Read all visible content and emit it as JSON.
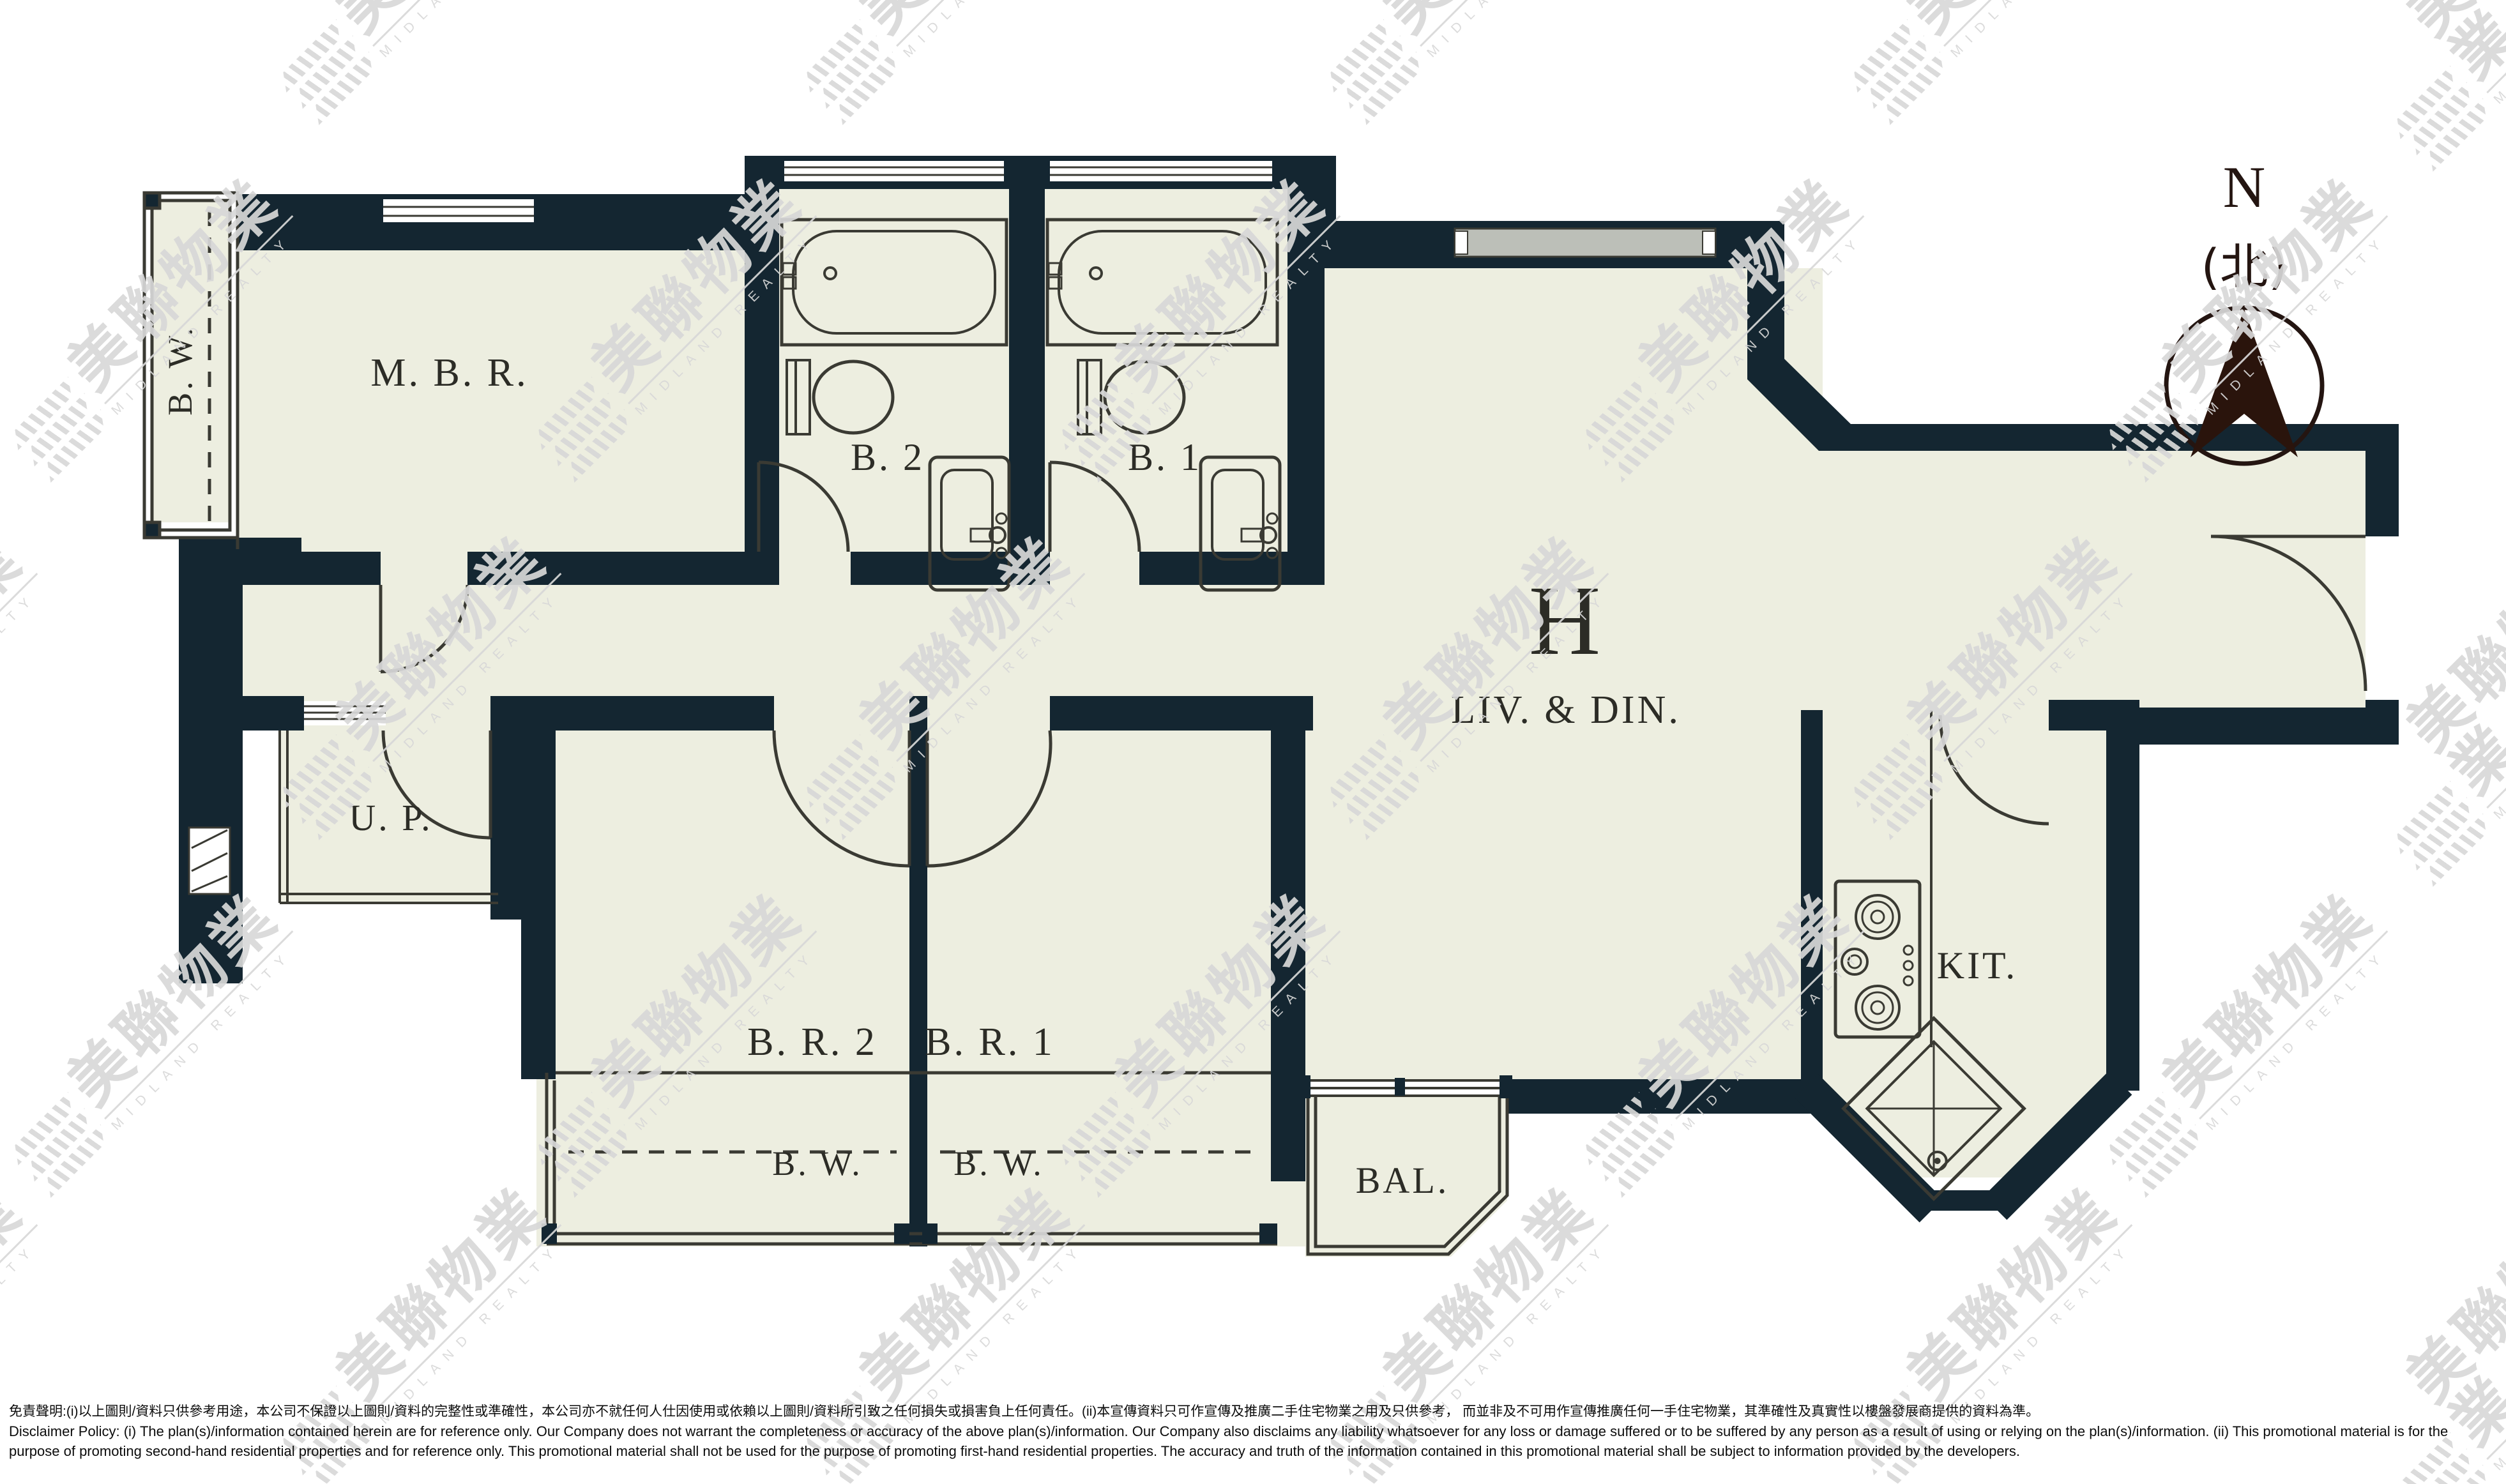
{
  "plan": {
    "unit_label": "H",
    "rooms": {
      "mbr": "M. B. R.",
      "b2": "B. 2",
      "b1": "B. 1",
      "bw_left": "B. W.",
      "up": "U. P.",
      "br2": "B. R. 2",
      "br1": "B. R. 1",
      "bw_br2": "B. W.",
      "bw_br1": "B. W.",
      "livdin": "LIV.  &  DIN.",
      "kit": "KIT.",
      "bal": "BAL."
    },
    "compass": {
      "n": "N",
      "north_cn": "(北)"
    }
  },
  "watermark": {
    "cn": "美聯物業",
    "en": "MIDLAND REALTY"
  },
  "disclaimer": {
    "zh": "免責聲明:(i)以上圖則/資料只供參考用途，本公司不保證以上圖則/資料的完整性或準確性，本公司亦不就任何人仕因使用或依賴以上圖則/資料所引致之任何損失或損害負上任何責任。(ii)本宣傳資料只可作宣傳及推廣二手住宅物業之用及只供參考， 而並非及不可用作宣傳推廣任何一手住宅物業，其準確性及真實性以樓盤發展商提供的資料為準。",
    "en1": "Disclaimer Policy: (i) The plan(s)/information contained herein are for reference only. Our Company does not warrant the completeness or accuracy of the above plan(s)/information. Our Company also disclaims any liability whatsoever for any loss or damage suffered or to be suffered by any person as a result of using or relying on the plan(s)/information. (ii) This promotional material is for the",
    "en2": "purpose of promoting second-hand residential properties and for reference only. This promotional material shall not be used for the purpose of promoting first-hand residential properties. The accuracy and truth of the information contained in this promotional material shall be subject to information provided by the developers."
  },
  "colors": {
    "wall": "#142631",
    "floor": "#edeee0",
    "line": "#3a3a33",
    "ink": "#2c2c26",
    "watermark": "#d8d8d8"
  }
}
